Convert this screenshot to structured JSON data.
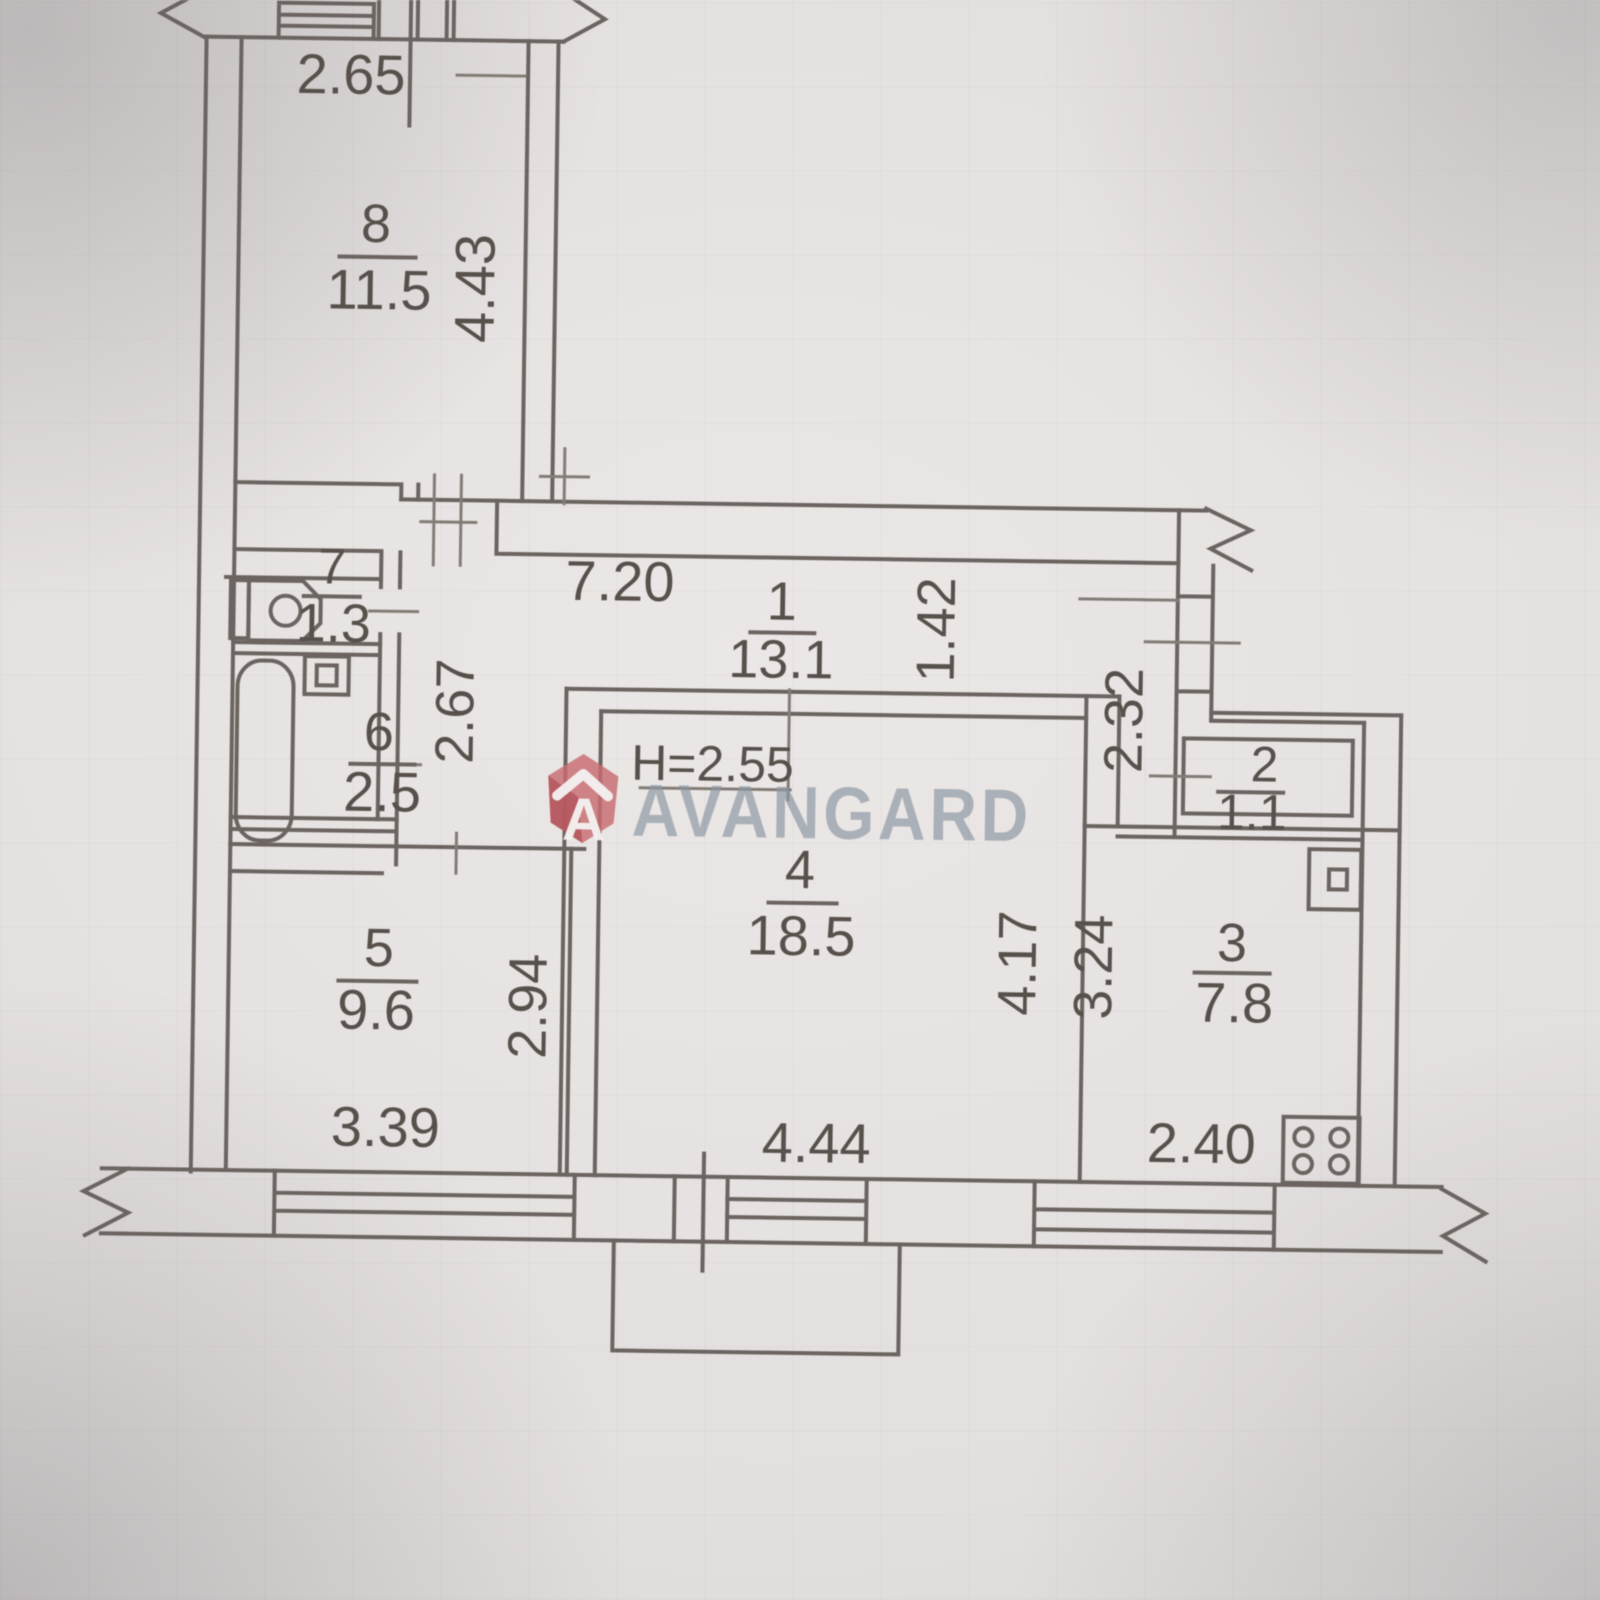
{
  "watermark": {
    "text": "AVANGARD",
    "logo": "avangard-hexagon-a-logo"
  },
  "ceiling_height": "H=2.55",
  "rooms": {
    "r1": {
      "number": "1",
      "area": "13.1"
    },
    "r2": {
      "number": "2",
      "area": "1.1"
    },
    "r3": {
      "number": "3",
      "area": "7.8"
    },
    "r4": {
      "number": "4",
      "area": "18.5"
    },
    "r5": {
      "number": "5",
      "area": "9.6"
    },
    "r6": {
      "number": "6",
      "area": "2.5"
    },
    "r7": {
      "number": "7",
      "area": "1.3"
    },
    "r8": {
      "number": "8",
      "area": "11.5"
    }
  },
  "dims": {
    "room8_width": "2.65",
    "room8_depth": "4.43",
    "hall_length": "7.20",
    "hall_depth": "1.42",
    "passage_left": "2.67",
    "passage_right": "2.32",
    "room5_width": "3.39",
    "room5_depth": "2.94",
    "room4_width": "4.44",
    "room4_depth": "4.17",
    "kitchen_depth": "3.24",
    "kitchen_width": "2.40"
  },
  "colors": {
    "paper": "#e4e0df",
    "line": "#6b6460",
    "line2": "#837c76",
    "text": "#57504b",
    "watermark_text": "#8d97a2",
    "logo_red": "#c96b72",
    "logo_red_dark": "#b2545c"
  }
}
